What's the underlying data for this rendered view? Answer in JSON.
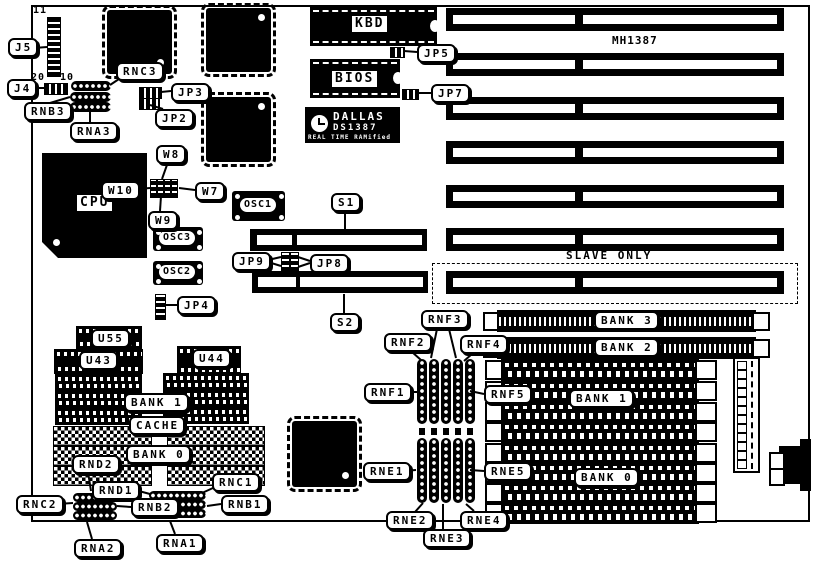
{
  "diagram": {
    "texts": {
      "board_model": "MH1387",
      "slave_only": "SLAVE ONLY",
      "j5_pin11": "11",
      "j5_pin20": "20",
      "j5_pin10": "10"
    },
    "dallas": {
      "brand": "DALLAS",
      "part": "DS1387",
      "tagline": "REAL TIME RAMified"
    },
    "chip_labels": {
      "kbd": "KBD",
      "bios": "BIOS",
      "cpu": "CPU",
      "osc1": "OSC1",
      "osc2": "OSC2",
      "osc3": "OSC3"
    },
    "callouts": {
      "j5": "J5",
      "j4": "J4",
      "rnb3": "RNB3",
      "rna3": "RNA3",
      "rnc3": "RNC3",
      "jp2": "JP2",
      "jp3": "JP3",
      "jp5": "JP5",
      "jp7": "JP7",
      "jp4": "JP4",
      "w8": "W8",
      "w10": "W10",
      "w7": "W7",
      "w9": "W9",
      "s1": "S1",
      "s2": "S2",
      "jp9": "JP9",
      "jp8": "JP8",
      "u55": "U55",
      "u43": "U43",
      "u44": "U44",
      "bank1_cache": "BANK 1",
      "cache": "CACHE",
      "bank0_cache": "BANK 0",
      "rnd2": "RND2",
      "rnd1": "RND1",
      "rnc1": "RNC1",
      "rnc2": "RNC2",
      "rnb2": "RNB2",
      "rnb1": "RNB1",
      "rna2": "RNA2",
      "rna1": "RNA1",
      "rnf1": "RNF1",
      "rnf2": "RNF2",
      "rnf3": "RNF3",
      "rnf4": "RNF4",
      "rnf5": "RNF5",
      "rne1": "RNE1",
      "rne2": "RNE2",
      "rne3": "RNE3",
      "rne4": "RNE4",
      "rne5": "RNE5",
      "bank3": "BANK 3",
      "bank2": "BANK 2",
      "bank1_simm": "BANK 1",
      "bank0_simm": "BANK 0"
    },
    "colors": {
      "ink": "#000000",
      "paper": "#ffffff"
    }
  }
}
